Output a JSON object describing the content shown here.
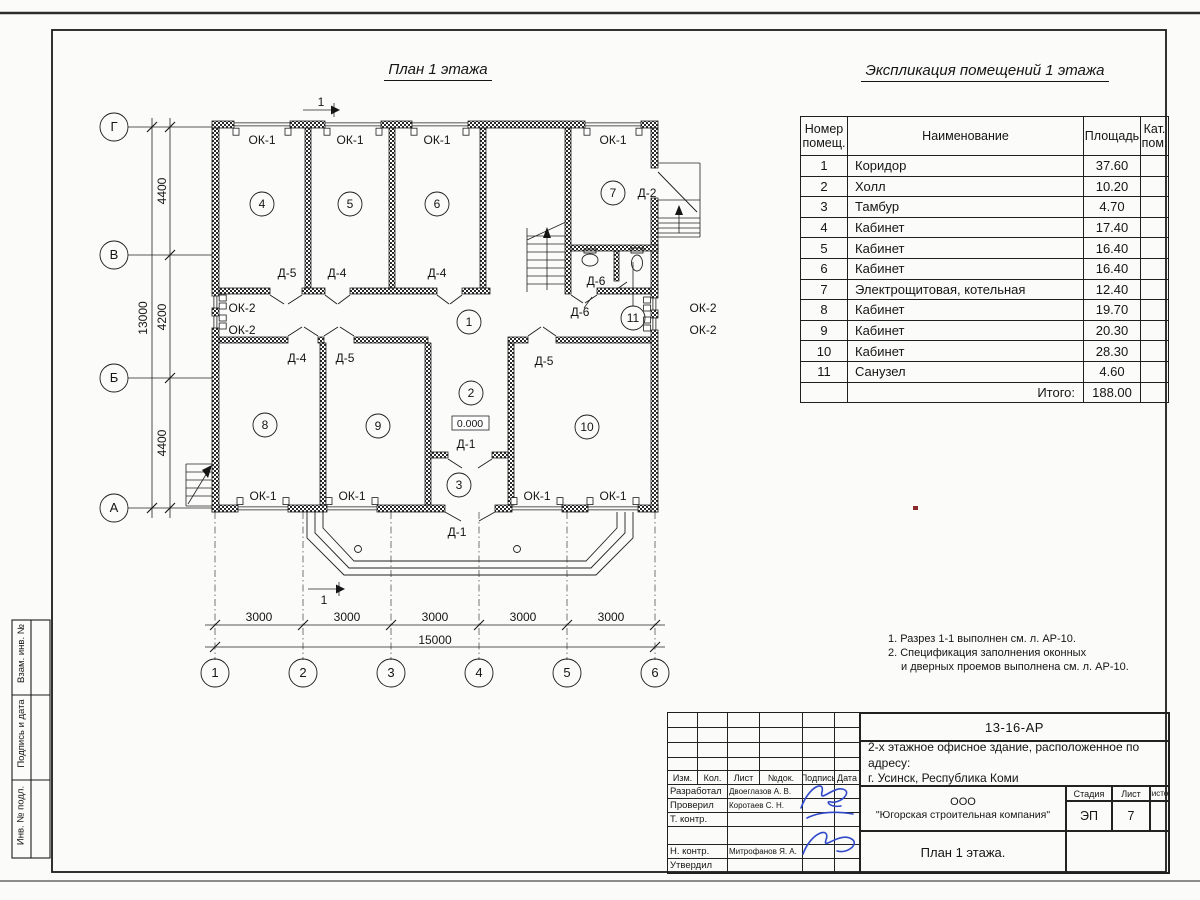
{
  "sheet": {
    "plan_title": "План 1 этажа",
    "table_title": "Экспликация помещений 1 этажа"
  },
  "sidebar": {
    "labels": [
      "Взам. инв. №",
      "Подпись и дата",
      "Инв. № подл."
    ]
  },
  "room_table": {
    "headers": {
      "number": "Номер помещ.",
      "name": "Наименование",
      "area": "Площадь",
      "category": "Кат. пом."
    },
    "rows": [
      {
        "number": "1",
        "name": "Коридор",
        "area": "37.60"
      },
      {
        "number": "2",
        "name": "Холл",
        "area": "10.20"
      },
      {
        "number": "3",
        "name": "Тамбур",
        "area": "4.70"
      },
      {
        "number": "4",
        "name": "Кабинет",
        "area": "17.40"
      },
      {
        "number": "5",
        "name": "Кабинет",
        "area": "16.40"
      },
      {
        "number": "6",
        "name": "Кабинет",
        "area": "16.40"
      },
      {
        "number": "7",
        "name": "Электрощитовая, котельная",
        "area": "12.40"
      },
      {
        "number": "8",
        "name": "Кабинет",
        "area": "19.70"
      },
      {
        "number": "9",
        "name": "Кабинет",
        "area": "20.30"
      },
      {
        "number": "10",
        "name": "Кабинет",
        "area": "28.30"
      },
      {
        "number": "11",
        "name": "Санузел",
        "area": "4.60"
      }
    ],
    "total_label": "Итого:",
    "total_value": "188.00"
  },
  "notes": [
    "1. Разрез 1-1 выполнен см. л. АР-10.",
    "2. Спецификация заполнения оконных",
    "и дверных проемов выполнена см. л. АР-10."
  ],
  "plan": {
    "level_mark": "0.000",
    "texts": [
      {
        "x": 262,
        "y": 144,
        "t": "ОК-1"
      },
      {
        "x": 350,
        "y": 144,
        "t": "ОК-1"
      },
      {
        "x": 437,
        "y": 144,
        "t": "ОК-1"
      },
      {
        "x": 613,
        "y": 144,
        "t": "ОК-1"
      },
      {
        "x": 647,
        "y": 197,
        "t": "Д-2"
      },
      {
        "x": 287,
        "y": 277,
        "t": "Д-5"
      },
      {
        "x": 337,
        "y": 277,
        "t": "Д-4"
      },
      {
        "x": 437,
        "y": 277,
        "t": "Д-4"
      },
      {
        "x": 596,
        "y": 285,
        "t": "Д-6"
      },
      {
        "x": 580,
        "y": 316,
        "t": "Д-6"
      },
      {
        "x": 242,
        "y": 312,
        "t": "ОК-2"
      },
      {
        "x": 242,
        "y": 334,
        "t": "ОК-2"
      },
      {
        "x": 703,
        "y": 312,
        "t": "ОК-2"
      },
      {
        "x": 703,
        "y": 334,
        "t": "ОК-2"
      },
      {
        "x": 297,
        "y": 362,
        "t": "Д-4"
      },
      {
        "x": 345,
        "y": 362,
        "t": "Д-5"
      },
      {
        "x": 544,
        "y": 365,
        "t": "Д-5"
      },
      {
        "x": 466,
        "y": 448,
        "t": "Д-1"
      },
      {
        "x": 457,
        "y": 536,
        "t": "Д-1"
      },
      {
        "x": 263,
        "y": 500,
        "t": "ОК-1"
      },
      {
        "x": 352,
        "y": 500,
        "t": "ОК-1"
      },
      {
        "x": 537,
        "y": 500,
        "t": "ОК-1"
      },
      {
        "x": 613,
        "y": 500,
        "t": "ОК-1"
      },
      {
        "x": 470,
        "y": 427,
        "t": "0.000",
        "fs": 10.5
      },
      {
        "x": 166,
        "y": 191,
        "t": "4400",
        "rot": 1
      },
      {
        "x": 166,
        "y": 317,
        "t": "4200",
        "rot": 1
      },
      {
        "x": 166,
        "y": 443,
        "t": "4400",
        "rot": 1
      },
      {
        "x": 147,
        "y": 318,
        "t": "13000",
        "rot": 1
      },
      {
        "x": 259,
        "y": 621,
        "t": "3000"
      },
      {
        "x": 347,
        "y": 621,
        "t": "3000"
      },
      {
        "x": 435,
        "y": 621,
        "t": "3000"
      },
      {
        "x": 523,
        "y": 621,
        "t": "3000"
      },
      {
        "x": 611,
        "y": 621,
        "t": "3000"
      },
      {
        "x": 435,
        "y": 644,
        "t": "15000"
      },
      {
        "x": 321,
        "y": 106,
        "t": "1"
      },
      {
        "x": 324,
        "y": 604,
        "t": "1"
      }
    ],
    "circles": [
      {
        "x": 262,
        "y": 204,
        "r": 12,
        "t": "4",
        "kind": "room"
      },
      {
        "x": 350,
        "y": 204,
        "r": 12,
        "t": "5",
        "kind": "room"
      },
      {
        "x": 437,
        "y": 204,
        "r": 12,
        "t": "6",
        "kind": "room"
      },
      {
        "x": 613,
        "y": 193,
        "r": 12,
        "t": "7",
        "kind": "room"
      },
      {
        "x": 469,
        "y": 322,
        "r": 12,
        "t": "1",
        "kind": "room"
      },
      {
        "x": 471,
        "y": 393,
        "r": 12,
        "t": "2",
        "kind": "room"
      },
      {
        "x": 459,
        "y": 485,
        "r": 12,
        "t": "3",
        "kind": "room"
      },
      {
        "x": 265,
        "y": 425,
        "r": 12,
        "t": "8",
        "kind": "room"
      },
      {
        "x": 378,
        "y": 426,
        "r": 12,
        "t": "9",
        "kind": "room"
      },
      {
        "x": 587,
        "y": 427,
        "r": 12,
        "t": "10",
        "kind": "room"
      },
      {
        "x": 633,
        "y": 318,
        "r": 12,
        "t": "11",
        "kind": "room"
      },
      {
        "x": 114,
        "y": 127,
        "r": 14,
        "t": "Г",
        "fs": 13,
        "kind": "axis"
      },
      {
        "x": 114,
        "y": 255,
        "r": 14,
        "t": "В",
        "fs": 13,
        "kind": "axis"
      },
      {
        "x": 114,
        "y": 378,
        "r": 14,
        "t": "Б",
        "fs": 13,
        "kind": "axis"
      },
      {
        "x": 114,
        "y": 508,
        "r": 14,
        "t": "А",
        "fs": 13,
        "kind": "axis"
      },
      {
        "x": 215,
        "y": 673,
        "r": 14,
        "t": "1",
        "fs": 13,
        "kind": "axis"
      },
      {
        "x": 303,
        "y": 673,
        "r": 14,
        "t": "2",
        "fs": 13,
        "kind": "axis"
      },
      {
        "x": 391,
        "y": 673,
        "r": 14,
        "t": "3",
        "fs": 13,
        "kind": "axis"
      },
      {
        "x": 479,
        "y": 673,
        "r": 14,
        "t": "4",
        "fs": 13,
        "kind": "axis"
      },
      {
        "x": 567,
        "y": 673,
        "r": 14,
        "t": "5",
        "fs": 13,
        "kind": "axis"
      },
      {
        "x": 655,
        "y": 673,
        "r": 14,
        "t": "6",
        "fs": 13,
        "kind": "axis"
      }
    ]
  },
  "title_block": {
    "doc_number": "13-16-АР",
    "project_line1": "2-х этажное офисное здание, расположенное по адресу:",
    "project_line2": "г. Усинск, Республика Коми",
    "company_line1": "ООО",
    "company_line2": "\"Югорская строительная компания\"",
    "drawing_name": "План 1 этажа.",
    "columns": [
      "Изм.",
      "Кол.",
      "Лист",
      "№док.",
      "Подпись",
      "Дата"
    ],
    "stage_label": "Стадия",
    "sheet_label": "Лист",
    "sheets_label": "Листов",
    "stage": "ЭП",
    "sheet_number": "7",
    "roles": [
      {
        "role": "Разработал",
        "name": "Двоеглазов А. В."
      },
      {
        "role": "Проверил",
        "name": "Коротаев С. Н."
      },
      {
        "role": "Т. контр.",
        "name": ""
      },
      {
        "role": "",
        "name": ""
      },
      {
        "role": "Н. контр.",
        "name": "Митрофанов Я. А."
      },
      {
        "role": "Утвердил",
        "name": ""
      }
    ]
  }
}
